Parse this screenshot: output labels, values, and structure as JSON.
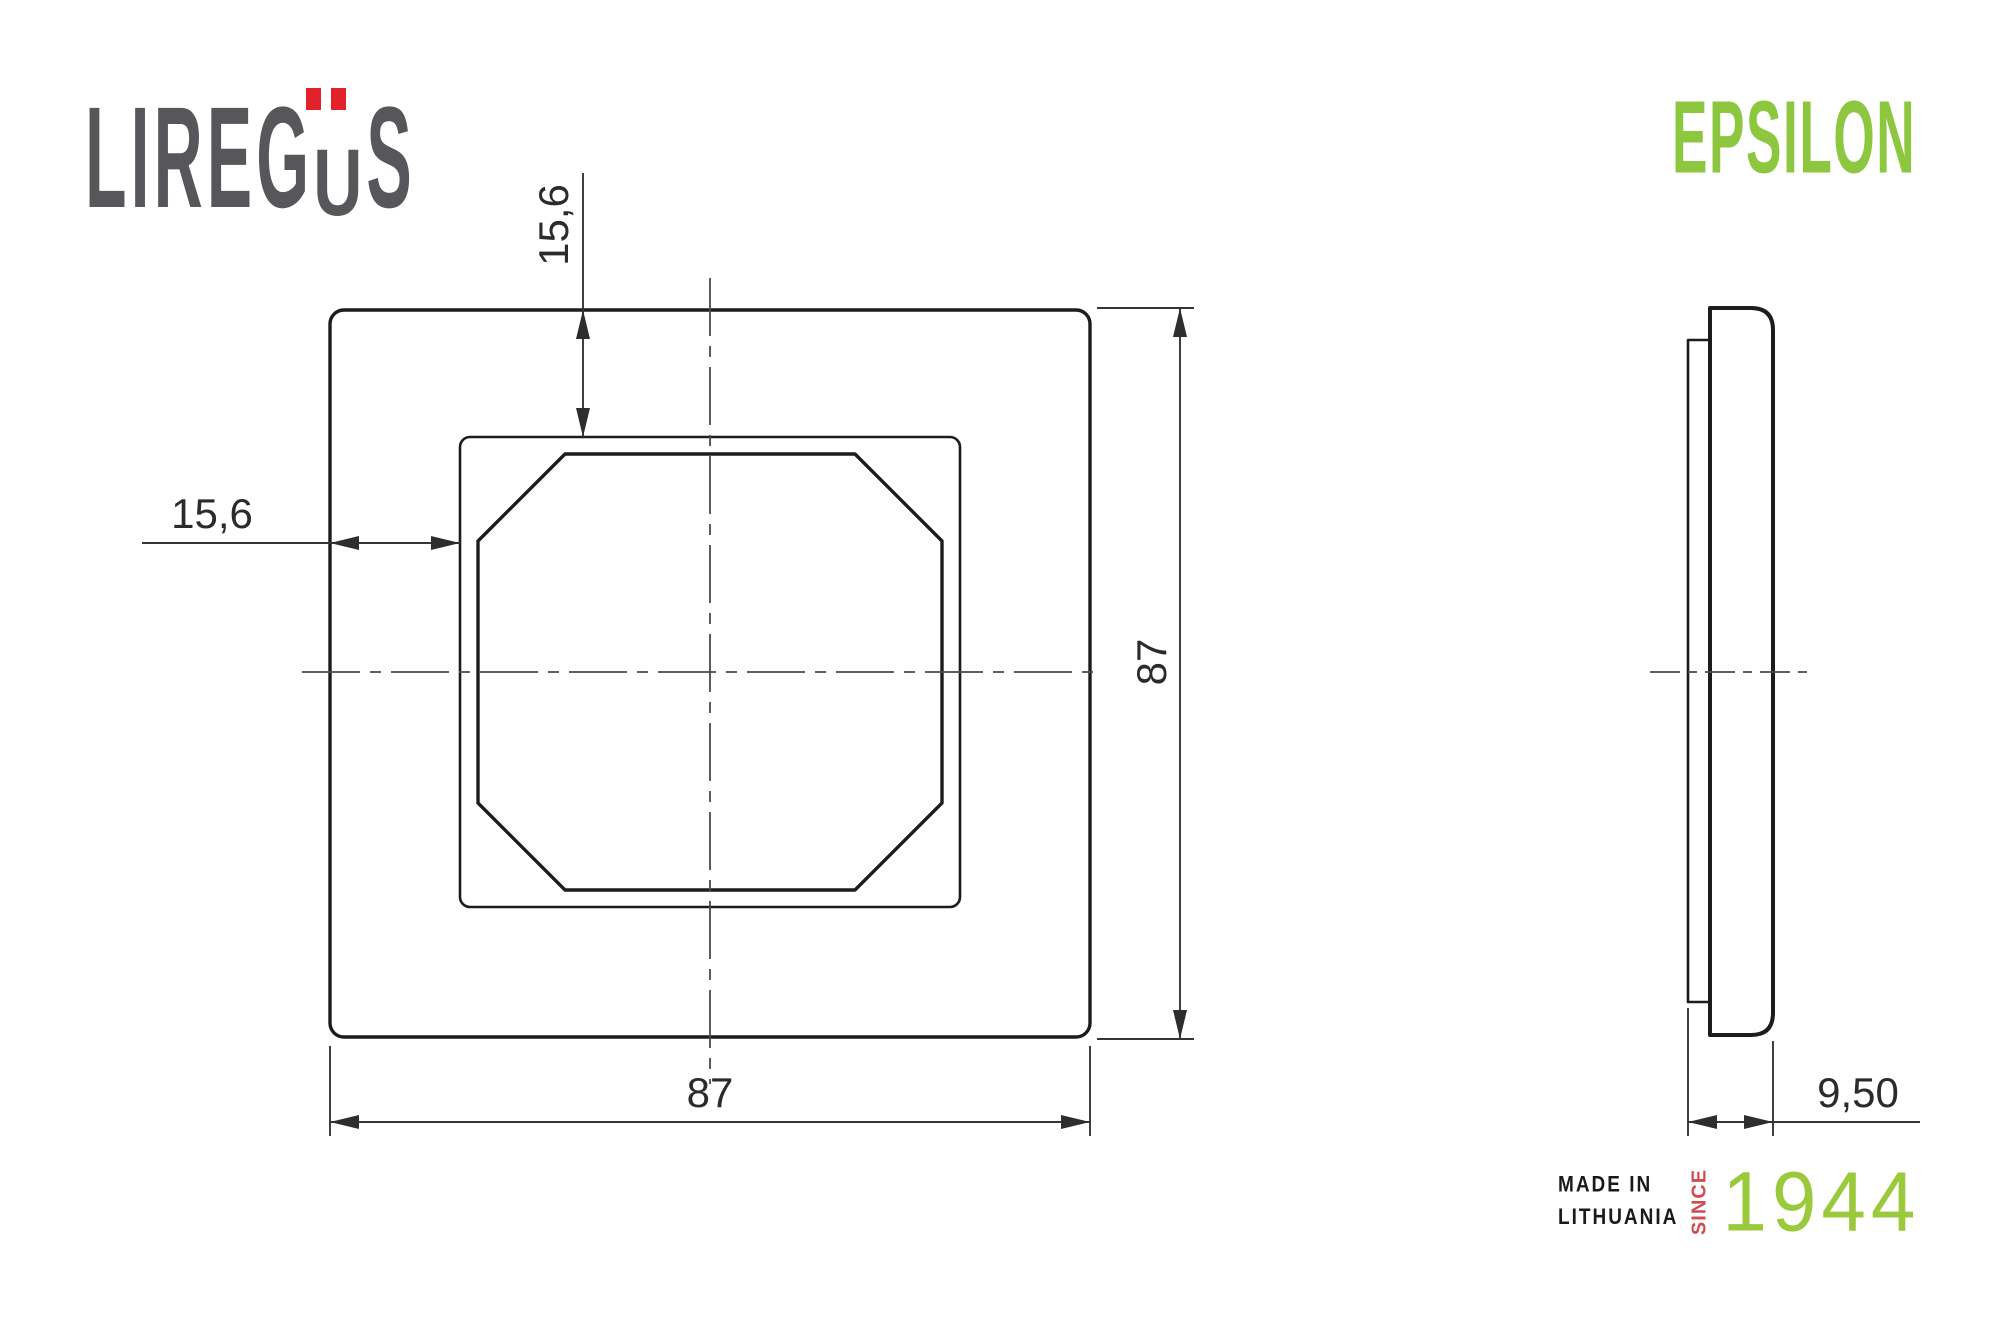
{
  "brand": {
    "logo_prefix": "LIREG",
    "logo_umlaut_letter": "U",
    "logo_suffix": "S",
    "logo_color": "#57575b",
    "umlaut_color": "#e3212a"
  },
  "product_line": {
    "name": "EPSILON",
    "color": "#8dc63f"
  },
  "drawing": {
    "line_color": "#1c1c1e",
    "dimension_color": "#2b2b2b",
    "labels": {
      "top_offset": "15,6",
      "left_offset": "15,6",
      "overall_height": "87",
      "overall_width": "87",
      "thickness": "9,50"
    }
  },
  "footer": {
    "made_in_line1": "MADE IN",
    "made_in_line2": "LITHUANIA",
    "since": "SINCE",
    "year": "1944",
    "text_color": "#1a1a1a",
    "since_color": "#d14b50",
    "year_color": "#9aca3c"
  }
}
